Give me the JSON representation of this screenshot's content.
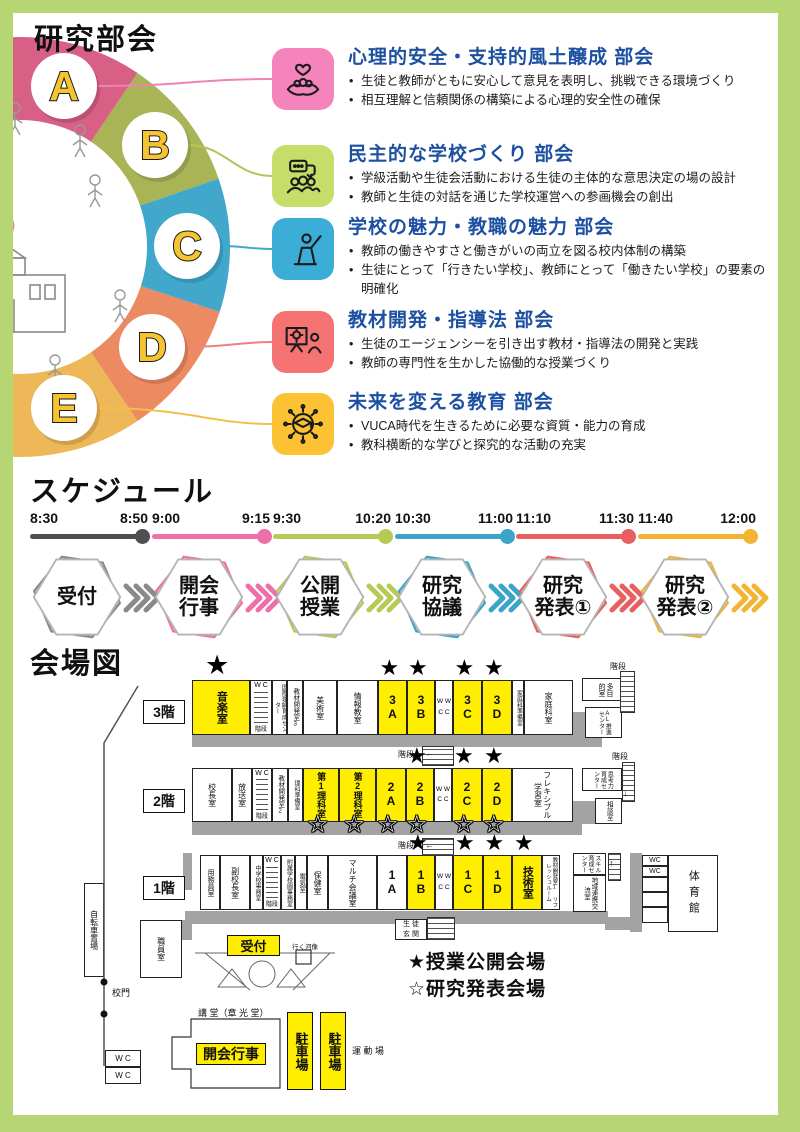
{
  "header": {
    "title": "研究部会"
  },
  "accent_blue": "#1d50a0",
  "subcommittees": [
    {
      "letter": "A",
      "arc_color": "#d85f85",
      "icon_bg": "#f584bc",
      "line_color": "#ef83b6",
      "icon": "hands-heart-icon",
      "title": "心理的安全・支持的風土醸成 部会",
      "bullets": [
        "生徒と教師がともに安心して意見を表明し、挑戦できる環境づくり",
        "相互理解と信頼関係の構築による心理的安全性の確保"
      ]
    },
    {
      "letter": "B",
      "arc_color": "#a9b457",
      "icon_bg": "#c6dd6a",
      "line_color": "#b3c45f",
      "icon": "discussion-icon",
      "title": "民主的な学校づくり 部会",
      "bullets": [
        "学級活動や生徒会活動における生徒の主体的な意思決定の場の設計",
        "教師と生徒の対話を通じた学校運営への参画機会の創出"
      ]
    },
    {
      "letter": "C",
      "arc_color": "#41a8cc",
      "icon_bg": "#3badd6",
      "line_color": "#41a8cc",
      "icon": "teacher-icon",
      "title": "学校の魅力・教職の魅力 部会",
      "bullets": [
        "教師の働きやすさと働きがいの両立を図る校内体制の構築",
        "生徒にとって「行きたい学校」、教師にとって「働きたい学校」の要素の明確化"
      ]
    },
    {
      "letter": "D",
      "arc_color": "#ec8a62",
      "icon_bg": "#f57373",
      "line_color": "#f28080",
      "icon": "idea-board-icon",
      "title": "教材開発・指導法 部会",
      "bullets": [
        "生徒のエージェンシーを引き出す教材・指導法の開発と実践",
        "教師の専門性を生かした協働的な授業づくり"
      ]
    },
    {
      "letter": "E",
      "arc_color": "#eeb757",
      "icon_bg": "#fcc233",
      "line_color": "#f2c04a",
      "icon": "future-education-icon",
      "title": "未来を変える教育 部会",
      "bullets": [
        "VUCA時代を生きるために必要な資質・能力の育成",
        "教科横断的な学びと探究的な活動の充実"
      ]
    }
  ],
  "schedule": {
    "title": "スケジュール",
    "items": [
      {
        "start": "8:30",
        "end": "8:50",
        "label": "受付",
        "lines": [
          "受付"
        ],
        "color": "#4f4f4f"
      },
      {
        "start": "9:00",
        "end": "9:15",
        "label": "開会行事",
        "lines": [
          "開会",
          "行事"
        ],
        "color": "#ef6fa9"
      },
      {
        "start": "9:30",
        "end": "10:20",
        "label": "公開授業",
        "lines": [
          "公開",
          "授業"
        ],
        "color": "#b6ca55"
      },
      {
        "start": "10:30",
        "end": "11:00",
        "label": "研究協議",
        "lines": [
          "研究",
          "協議"
        ],
        "color": "#3ba4c8"
      },
      {
        "start": "11:10",
        "end": "11:30",
        "label": "研究発表①",
        "lines": [
          "研究",
          "発表①"
        ],
        "color": "#e95f5f"
      },
      {
        "start": "11:40",
        "end": "12:00",
        "label": "研究発表②",
        "lines": [
          "研究",
          "発表②"
        ],
        "color": "#f3b433"
      }
    ]
  },
  "map": {
    "title": "会場図",
    "legend": [
      "★授業公開会場",
      "☆研究発表会場"
    ],
    "floor_labels": [
      {
        "text": "3階",
        "x": 143,
        "y": 700
      },
      {
        "text": "2階",
        "x": 143,
        "y": 789
      },
      {
        "text": "1階",
        "x": 143,
        "y": 876
      }
    ],
    "floors": [
      {
        "y": 680,
        "h": 55,
        "corridor": {
          "x": 192,
          "y": 735,
          "w": 381,
          "h": 12
        },
        "rooms": [
          {
            "x": 192,
            "w": 58,
            "label": "音楽室",
            "yellow": true,
            "starTop": true,
            "vert": true,
            "fs": 11,
            "bold": true,
            "bigStar": true
          },
          {
            "x": 250,
            "w": 22,
            "wcStairs": true,
            "wc": "W C",
            "kaidan": "階段"
          },
          {
            "x": 272,
            "w": 15,
            "label": "国際理解育成センター",
            "vert": true,
            "fs": 6
          },
          {
            "x": 287,
            "w": 16,
            "label": "教材開発室3",
            "vert": true,
            "fs": 6.5
          },
          {
            "x": 303,
            "w": 34,
            "label": "美術室",
            "vert": true,
            "fs": 8
          },
          {
            "x": 337,
            "w": 41,
            "label": "情報教室",
            "vert": true,
            "fs": 8
          },
          {
            "x": 378,
            "w": 29,
            "label": "3A",
            "stack": true,
            "yellow": true,
            "starTop": true
          },
          {
            "x": 407,
            "w": 28,
            "label": "3B",
            "stack": true,
            "yellow": true,
            "starTop": true
          },
          {
            "x": 435,
            "w": 18,
            "wc2": true,
            "lines": [
              "W W",
              "C C"
            ]
          },
          {
            "x": 453,
            "w": 29,
            "label": "3C",
            "stack": true,
            "yellow": true,
            "starTop": true
          },
          {
            "x": 482,
            "w": 30,
            "label": "3D",
            "stack": true,
            "yellow": true,
            "starTop": true
          },
          {
            "x": 512,
            "w": 12,
            "label": "家庭科準備室",
            "vert": true,
            "fs": 6
          },
          {
            "x": 524,
            "w": 49,
            "label": "家庭科室",
            "vert": true,
            "fs": 8
          }
        ]
      },
      {
        "y": 768,
        "h": 54,
        "corridor": {
          "x": 192,
          "y": 822,
          "w": 390,
          "h": 13
        },
        "rooms": [
          {
            "x": 192,
            "w": 40,
            "label": "校長室",
            "vert": true,
            "fs": 8
          },
          {
            "x": 232,
            "w": 20,
            "label": "放送室",
            "vert": true,
            "fs": 8
          },
          {
            "x": 252,
            "w": 20,
            "wcStairs": true,
            "wc": "W C",
            "kaidan": "階段"
          },
          {
            "x": 272,
            "w": 16,
            "label": "教材開発室2",
            "vert": true,
            "fs": 6.5
          },
          {
            "x": 288,
            "w": 15,
            "label": "理科準備室",
            "vert": true,
            "fs": 6
          },
          {
            "x": 303,
            "w": 36,
            "label": "第1理科室",
            "vert": true,
            "fs": 9,
            "bold": true,
            "yellow": true,
            "starBottom": true
          },
          {
            "x": 339,
            "w": 37,
            "label": "第2理科室",
            "vert": true,
            "fs": 9,
            "bold": true,
            "yellow": true,
            "starBottom": true
          },
          {
            "x": 376,
            "w": 30,
            "label": "2A",
            "stack": true,
            "yellow": true,
            "starBottom": true
          },
          {
            "x": 406,
            "w": 28,
            "label": "2B",
            "stack": true,
            "yellow": true,
            "starTop": true,
            "starBottom": true
          },
          {
            "x": 434,
            "w": 18,
            "wc2": true,
            "lines": [
              "W W",
              "C C"
            ]
          },
          {
            "x": 452,
            "w": 30,
            "label": "2C",
            "stack": true,
            "yellow": true,
            "starTop": true,
            "starBottom": true
          },
          {
            "x": 482,
            "w": 30,
            "label": "2D",
            "stack": true,
            "yellow": true,
            "starTop": true,
            "starBottom": true
          },
          {
            "x": 512,
            "w": 61,
            "label": "フレキシブル学習室",
            "vert": true,
            "fs": 8
          }
        ]
      },
      {
        "y": 855,
        "h": 55,
        "corridor": {
          "x": 185,
          "y": 911,
          "w": 423,
          "h": 13
        },
        "rooms": [
          {
            "x": 200,
            "w": 20,
            "label": "用務員室",
            "vert": true,
            "fs": 7
          },
          {
            "x": 220,
            "w": 30,
            "label": "副校長室",
            "vert": true,
            "fs": 8
          },
          {
            "x": 250,
            "w": 13,
            "label": "中学校事務室",
            "vert": true,
            "fs": 6
          },
          {
            "x": 263,
            "w": 18,
            "wcStairs": true,
            "wc": "W C",
            "kaidan": "階段"
          },
          {
            "x": 281,
            "w": 14,
            "label": "附属学校園事務室",
            "vert": true,
            "fs": 6
          },
          {
            "x": 295,
            "w": 12,
            "label": "電気室",
            "vert": true,
            "fs": 6.5
          },
          {
            "x": 307,
            "w": 21,
            "label": "保健室",
            "vert": true,
            "fs": 8
          },
          {
            "x": 328,
            "w": 49,
            "label": "マルチ会議室",
            "vert": true,
            "fs": 8
          },
          {
            "x": 377,
            "w": 30,
            "label": "1A",
            "stack": true
          },
          {
            "x": 407,
            "w": 28,
            "label": "1B",
            "stack": true,
            "yellow": true,
            "starTop": true
          },
          {
            "x": 435,
            "w": 18,
            "wc2": true,
            "lines": [
              "W W",
              "C C"
            ]
          },
          {
            "x": 453,
            "w": 30,
            "label": "1C",
            "stack": true,
            "yellow": true,
            "starTop": true
          },
          {
            "x": 483,
            "w": 29,
            "label": "1D",
            "stack": true,
            "yellow": true,
            "starTop": true
          },
          {
            "x": 512,
            "w": 30,
            "label": "技術室",
            "vert": true,
            "fs": 11,
            "bold": true,
            "yellow": true,
            "starTop": true
          },
          {
            "x": 542,
            "w": 18,
            "label": "教材開発室1 リフレッシュルーム",
            "vert": true,
            "fs": 5.5
          }
        ]
      }
    ],
    "annex": [
      {
        "label": "多目的室",
        "x": 582,
        "y": 678,
        "w": 46,
        "h": 23,
        "vert": true,
        "fs": 7
      },
      {
        "label": "AL推進センター",
        "x": 585,
        "y": 707,
        "w": 37,
        "h": 31,
        "vert": true,
        "fs": 6
      },
      {
        "label": "思考力育成センター",
        "x": 582,
        "y": 768,
        "w": 40,
        "h": 23,
        "vert": true,
        "fs": 6
      },
      {
        "label": "相談室",
        "x": 595,
        "y": 798,
        "w": 27,
        "h": 26,
        "vert": true,
        "fs": 6.5
      },
      {
        "label": "スキル育成センター",
        "x": 573,
        "y": 853,
        "w": 33,
        "h": 22,
        "vert": true,
        "fs": 6
      },
      {
        "label": "地域連携交流室",
        "x": 573,
        "y": 875,
        "w": 33,
        "h": 37,
        "vert": true,
        "fs": 6.5
      },
      {
        "label": "WC",
        "x": 642,
        "y": 855,
        "w": 26,
        "h": 11,
        "fs": 7
      },
      {
        "label": "WC",
        "x": 642,
        "y": 866,
        "w": 26,
        "h": 11,
        "fs": 7
      },
      {
        "label": "",
        "x": 642,
        "y": 877,
        "w": 26,
        "h": 15
      },
      {
        "label": "",
        "x": 642,
        "y": 892,
        "w": 26,
        "h": 15
      },
      {
        "label": "",
        "x": 642,
        "y": 907,
        "w": 26,
        "h": 16
      },
      {
        "label": "体育館",
        "x": 668,
        "y": 855,
        "w": 50,
        "h": 77,
        "vert": true,
        "fs": 11,
        "ls": 5
      },
      {
        "label": "職員室",
        "x": 140,
        "y": 920,
        "w": 42,
        "h": 58,
        "vert": true,
        "fs": 8
      },
      {
        "label": "自転車置場",
        "x": 84,
        "y": 883,
        "w": 20,
        "h": 94,
        "vert": true,
        "fs": 8
      },
      {
        "label": "生徒玄関",
        "x": 395,
        "y": 919,
        "w": 32,
        "h": 21,
        "fs": 7,
        "lines": [
          "生 徒",
          "玄 関"
        ]
      },
      {
        "label": "W C",
        "x": 105,
        "y": 1050,
        "w": 36,
        "h": 17,
        "fs": 8
      },
      {
        "label": "W C",
        "x": 105,
        "y": 1067,
        "w": 36,
        "h": 17,
        "fs": 8
      }
    ],
    "stairs": [
      {
        "x": 422,
        "y": 746,
        "w": 32,
        "h": 20,
        "label": "階段",
        "lx": 398,
        "ly": 749,
        "arrow": "←",
        "ax": 425,
        "ay": 748
      },
      {
        "x": 422,
        "y": 838,
        "w": 32,
        "h": 18,
        "label": "階段",
        "lx": 398,
        "ly": 840,
        "arrow": "←",
        "ax": 425,
        "ay": 840
      },
      {
        "x": 620,
        "y": 671,
        "w": 15,
        "h": 42,
        "label": "階段",
        "lx": 610,
        "ly": 661
      },
      {
        "x": 622,
        "y": 762,
        "w": 13,
        "h": 40,
        "label": "階段",
        "lx": 612,
        "ly": 751,
        "arrow": "↓",
        "ax": 623,
        "ay": 788
      },
      {
        "x": 608,
        "y": 853,
        "w": 13,
        "h": 28,
        "arrow": "↑",
        "ax": 609,
        "ay": 858
      },
      {
        "x": 427,
        "y": 917,
        "w": 28,
        "h": 23
      }
    ],
    "grays": [
      [
        192,
        735,
        381,
        12
      ],
      [
        571,
        712,
        31,
        35
      ],
      [
        192,
        822,
        390,
        13
      ],
      [
        571,
        801,
        31,
        23
      ],
      [
        185,
        911,
        423,
        13
      ],
      [
        605,
        917,
        35,
        13
      ],
      [
        183,
        853,
        9,
        37
      ],
      [
        180,
        920,
        12,
        20
      ],
      [
        630,
        853,
        12,
        79
      ]
    ],
    "yellow_boxes": [
      {
        "t": "受付",
        "x": 227,
        "y": 935,
        "w": 53,
        "h": 21,
        "fs": 13
      },
      {
        "t": "開会行事",
        "x": 196,
        "y": 1043,
        "w": 70,
        "h": 22,
        "fs": 14
      },
      {
        "t": "駐車場",
        "x": 287,
        "y": 1012,
        "w": 26,
        "h": 78,
        "fs": 13,
        "vert": true
      },
      {
        "t": "駐車場",
        "x": 320,
        "y": 1012,
        "w": 26,
        "h": 78,
        "fs": 13,
        "vert": true
      }
    ],
    "texts": [
      {
        "t": "行く河像",
        "x": 292,
        "y": 941,
        "fs": 6.5
      },
      {
        "t": "校門",
        "x": 112,
        "y": 986,
        "fs": 9
      },
      {
        "t": "運 動 場",
        "x": 352,
        "y": 1044,
        "fs": 9
      },
      {
        "t": "講 堂（章 光 堂）",
        "x": 198,
        "y": 1006,
        "fs": 9
      }
    ]
  }
}
